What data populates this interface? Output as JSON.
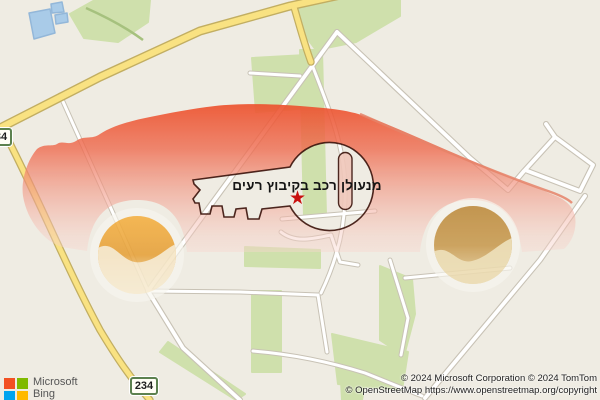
{
  "marker": {
    "label": "מנעולן רכב בקיבוץ רעים",
    "star": "★"
  },
  "roads": {
    "shield_bottom": "234",
    "shield_left": "234"
  },
  "branding": {
    "company": "Microsoft",
    "product": "Bing"
  },
  "attribution": {
    "line1": "© 2024 Microsoft Corporation © 2024 TomTom",
    "line2": "© OpenStreetMap https://www.openstreetmap.org/copyright"
  },
  "colors": {
    "map_background": "#efece3",
    "map_green": "#cfe0ac",
    "map_water": "#a9cbe8",
    "road_yellow": "#f9e282",
    "road_white": "#ffffff",
    "car_red_top": "#ec4f2a",
    "car_pink_bottom": "#f8dcd4",
    "wheel_left_gold": "#f4ad3c",
    "wheel_right_bronze": "#bd8a3c",
    "key_outline": "#3a120a",
    "star_red": "#c9100f",
    "shield_border_green": "#5c814f",
    "ms_logo_red": "#f25022",
    "ms_logo_green": "#7fba00",
    "ms_logo_blue": "#00a4ef",
    "ms_logo_yellow": "#ffb900"
  }
}
